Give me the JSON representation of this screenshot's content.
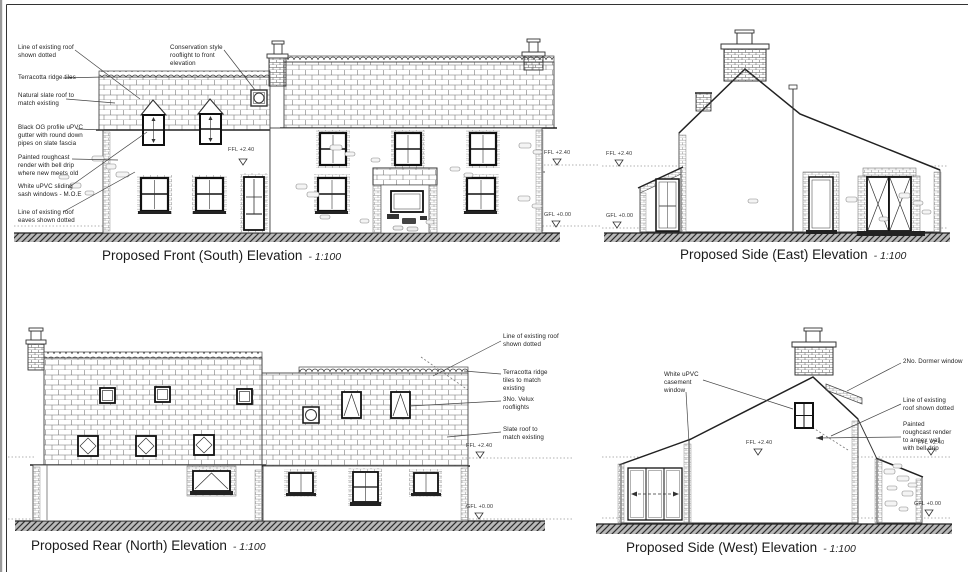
{
  "front": {
    "title": "Proposed Front (South) Elevation",
    "scale": "- 1:100",
    "labels": {
      "existing_roof": "Line of existing roof shown dotted",
      "ridge_tiles": "Terracotta ridge tiles",
      "slate_roof": "Natural slate roof to match existing",
      "gutter": "Black OG profile uPVC gutter with round down pipes on slate fascia",
      "render": "Painted roughcast render with bell drip where new meets old",
      "sash_windows": "White uPVC sliding sash windows - M.O.E",
      "eaves": "Line of existing roof eaves shown dotted",
      "rooflight": "Conservation style rooflight to front elevation"
    },
    "levels": {
      "ffl": "FFL +2.40",
      "ffl_mid": "FFL +2.40",
      "gfl": "GFL +0.00"
    }
  },
  "east": {
    "title": "Proposed Side (East) Elevation",
    "scale": "- 1:100",
    "levels": {
      "ffl": "FFL +2.40",
      "gfl": "GFL +0.00"
    }
  },
  "rear": {
    "title": "Proposed Rear (North) Elevation",
    "scale": "- 1:100",
    "labels": {
      "existing_roof": "Line of existing roof shown dotted",
      "ridge_tiles": "Terracotta ridge tiles to match existing",
      "velux": "3No. Velux rooflights",
      "slate_roof": "Slate roof to match existing"
    },
    "levels": {
      "ffl": "FFL +2.40",
      "gfl": "GFL +0.00"
    }
  },
  "west": {
    "title": "Proposed Side (West) Elevation",
    "scale": "- 1:100",
    "labels": {
      "casement": "White uPVC casement window",
      "dormer": "2No. Dormer window",
      "existing_roof": "Line of existing roof shown dotted",
      "render": "Painted roughcast render to annex wall with bell drip"
    },
    "levels": {
      "ffl": "FFL +2.40",
      "ffl_mid": "FFL +2.40",
      "gfl": "GFL +0.00"
    }
  }
}
